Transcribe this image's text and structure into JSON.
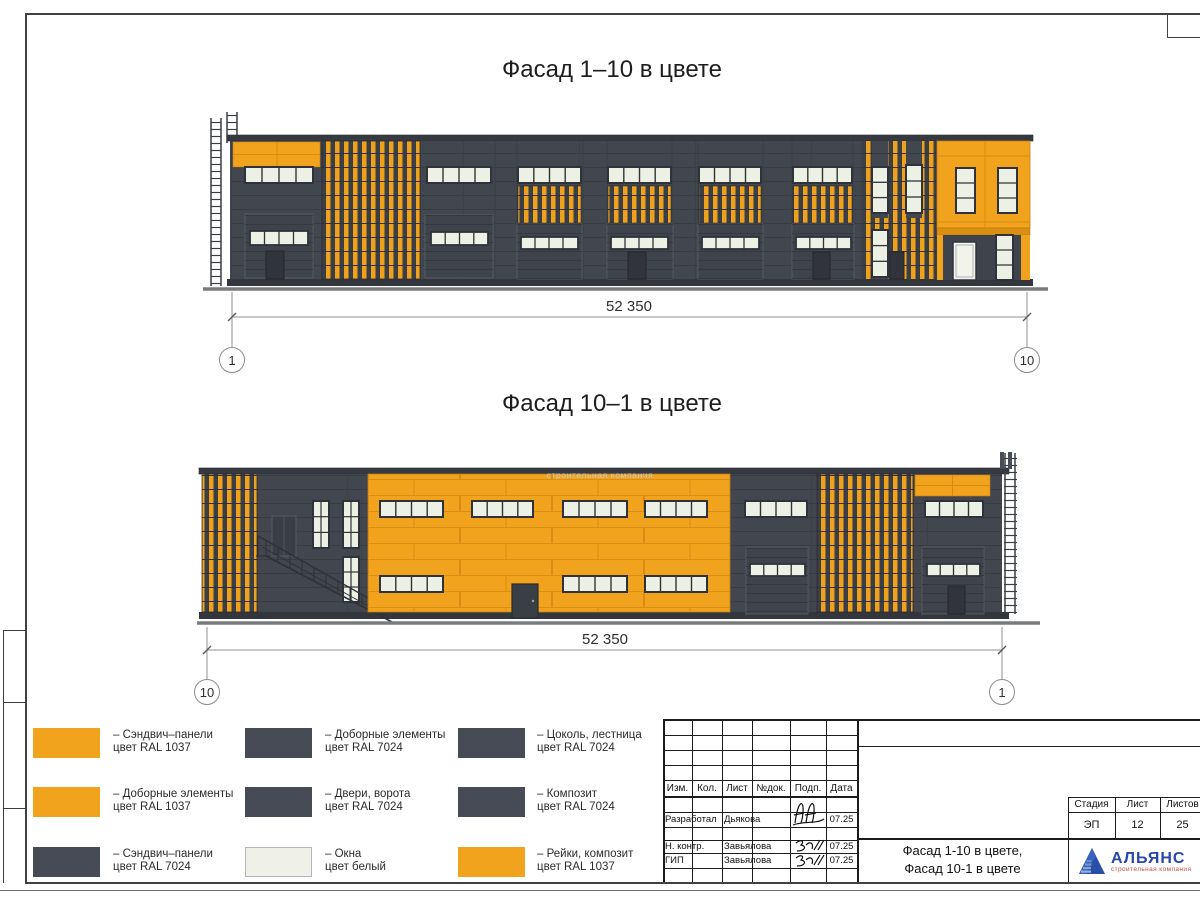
{
  "colors": {
    "ral1037_orange": "#F2A31E",
    "ral7024_dark": "#474B55",
    "window_white": "#EFF1E8",
    "facade_body": "#42464E",
    "logo_blue": "#2847A8",
    "logo_red": "#C0504D"
  },
  "titles": {
    "facade_top": "Фасад 1–10 в цвете",
    "facade_bottom": "Фасад 10–1 в цвете"
  },
  "elevation_top": {
    "dimension": "52 350",
    "axis_left": "1",
    "axis_right": "10"
  },
  "elevation_bottom": {
    "dimension": "52 350",
    "axis_left": "10",
    "axis_right": "1",
    "watermark": "строительная компания"
  },
  "legend": {
    "items": [
      {
        "swatch": "ral1037_orange",
        "line1": "– Сэндвич–панели",
        "line2": "цвет RAL 1037"
      },
      {
        "swatch": "ral1037_orange",
        "line1": "– Доборные элементы",
        "line2": "цвет RAL 1037"
      },
      {
        "swatch": "ral7024_dark",
        "line1": "– Сэндвич–панели",
        "line2": "цвет RAL 7024"
      },
      {
        "swatch": "ral7024_dark",
        "line1": "– Доборные элементы",
        "line2": "цвет RAL 7024"
      },
      {
        "swatch": "ral7024_dark",
        "line1": "– Двери, ворота",
        "line2": "цвет RAL 7024"
      },
      {
        "swatch": "window_white",
        "line1": "– Окна",
        "line2": "цвет белый"
      },
      {
        "swatch": "ral7024_dark",
        "line1": "– Цоколь, лестница",
        "line2": "цвет RAL 7024"
      },
      {
        "swatch": "ral7024_dark",
        "line1": "– Композит",
        "line2": "цвет RAL 7024"
      },
      {
        "swatch": "ral1037_orange",
        "line1": "– Рейки, композит",
        "line2": "цвет RAL 1037"
      }
    ]
  },
  "stamp": {
    "rev_headers": [
      "Изм.",
      "Кол.",
      "Лист",
      "№док.",
      "Подп.",
      "Дата"
    ],
    "rows": [
      {
        "role": "Разработал",
        "name": "Дьякова",
        "date": "07.25"
      },
      {
        "role": "Н. контр.",
        "name": "Завьялова",
        "date": "07.25"
      },
      {
        "role": "ГИП",
        "name": "Завьялова",
        "date": "07.25"
      }
    ],
    "doc_title_line1": "Фасад 1-10 в цвете,",
    "doc_title_line2": "Фасад 10-1 в цвете",
    "stage_label": "Стадия",
    "sheet_label": "Лист",
    "sheets_label": "Листов",
    "stage_value": "ЭП",
    "sheet_value": "12",
    "sheets_value": "25",
    "logo_name": "АЛЬЯНС",
    "logo_subtitle": "строительная компания"
  }
}
